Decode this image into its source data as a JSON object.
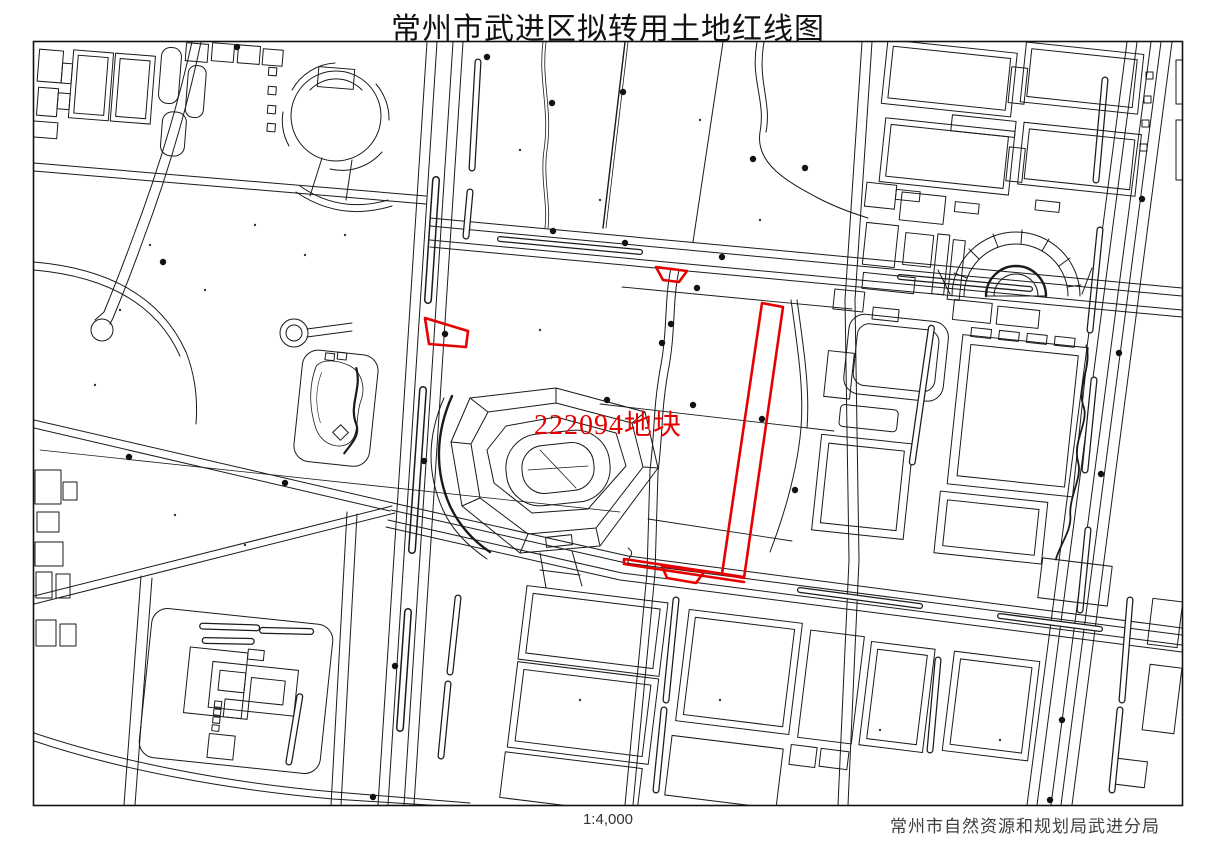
{
  "header": {
    "title": "常州市武进区拟转用土地红线图"
  },
  "map": {
    "parcel": {
      "id": "222094",
      "label": "222094地块"
    },
    "colors": {
      "redline": "#e60000",
      "linework": "#1a1a1a",
      "paper": "#ffffff"
    }
  },
  "footer": {
    "scale": "1:4,000",
    "agency": "常州市自然资源和规划局武进分局"
  }
}
